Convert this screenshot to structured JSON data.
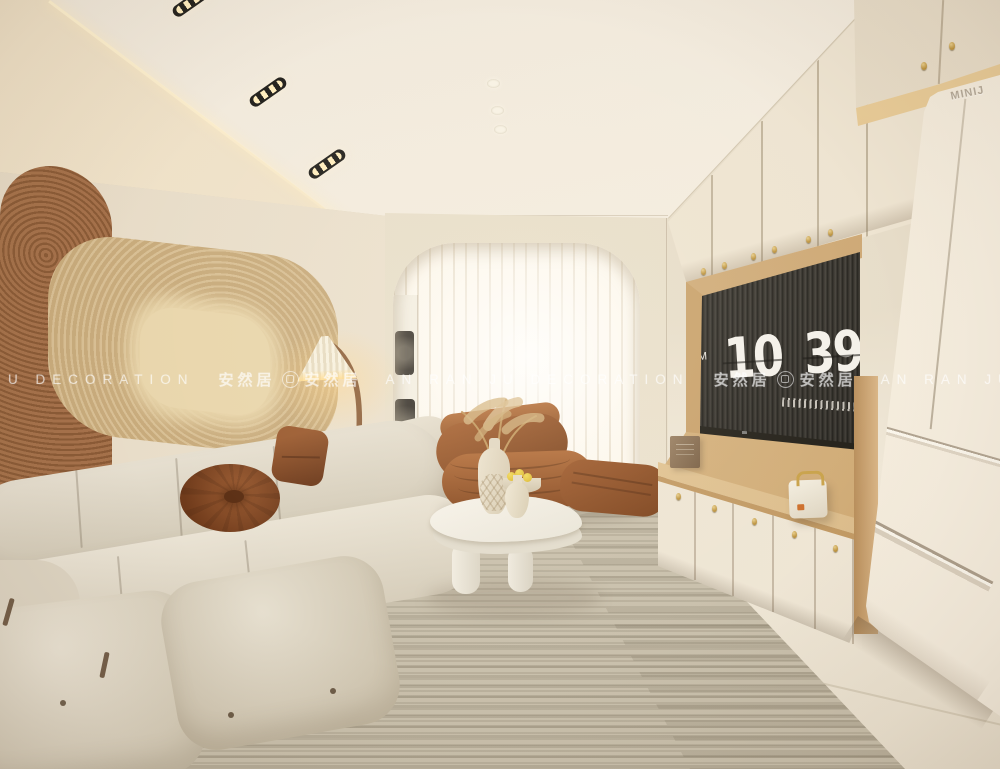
{
  "watermark": {
    "left_text": "U DECORATION",
    "brand_cn": "安然居",
    "center_text": "AN RAN JU DECORATION",
    "right_text": "AN RAN JU DEC"
  },
  "tv_screensaver": {
    "meridiem": "AM",
    "hour": "10",
    "minute": "39"
  },
  "appliance_brand": "MINIJ",
  "palette": {
    "wall": "#e9dfca",
    "ceiling": "#f3ecdf",
    "floor": "#ece3d1",
    "wood": "#d6b586",
    "gold_hardware": "#c9a24a",
    "sofa": "#ddd5c5",
    "rug": "#c9c0ac",
    "accent_rust": "#8a4d28",
    "curtain_glow": "#fdf8ee",
    "tv_screen": "#38342d",
    "clock_text": "#f4f1ea",
    "watermark_color": "rgba(255,255,255,0.55)"
  }
}
